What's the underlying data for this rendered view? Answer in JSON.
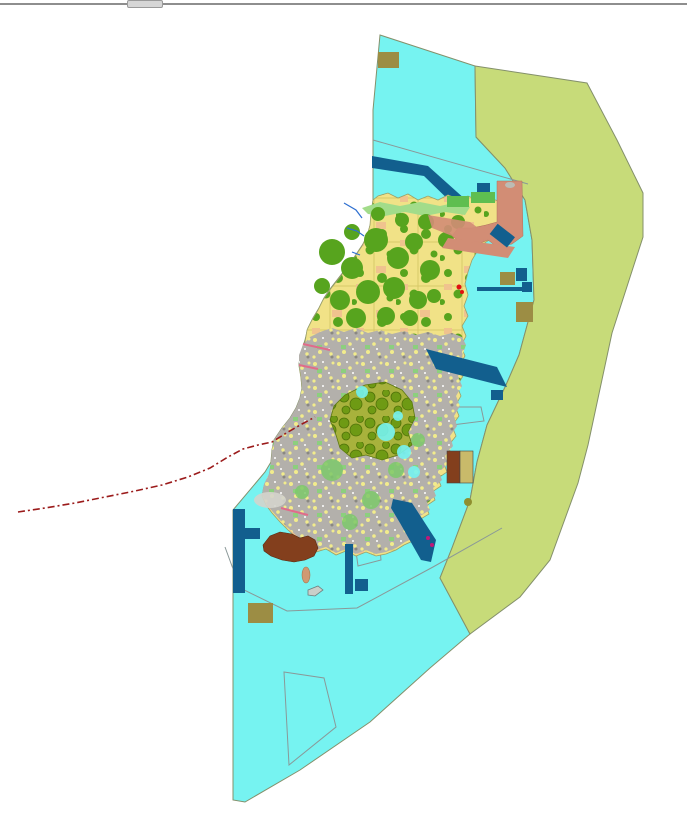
{
  "window": {
    "top_border": "window top border",
    "tab": "window tab stub"
  },
  "map": {
    "title": "coastal land-use zoning map",
    "width": 687,
    "height": 821,
    "background": "#FFFFFF",
    "palette": {
      "chrome-line": "#8E8E8E",
      "chrome-tab": "#D6D6D6",
      "sea": "#76F3F1",
      "olive-zone": "#C7DB79",
      "zone-stroke": "#84906B",
      "farmland": "#F1E287",
      "forest": "#57A41E",
      "orchard": "#F0C38E",
      "urban": "#B3B0AB",
      "parkgreen": "#5FBE50",
      "greens": "#8CCF7E",
      "harbor": "#125F8E",
      "salmon": "#D28D75",
      "brown": "#833F1D",
      "khaki": "#9C8D44",
      "khaki-light": "#C9BA6A",
      "coast-green": "#A2DC8A",
      "stream": "#2E6FD0",
      "boundary": "#9B1B1B",
      "hairline": "#8A9898",
      "forest-dense-base": "#A8B23C",
      "forest-dense-blob": "#6E9A14",
      "tidal": "#D4D4CC",
      "red-marker": "#E01010",
      "magenta-marker": "#C01878",
      "tan": "#D09A72",
      "boat-gray": "#C9CFC9"
    },
    "layers": [
      {
        "name": "sea-planning-area",
        "kind": "polygon",
        "fill": "@sea",
        "stroke": "@zone-stroke",
        "sw": 1,
        "points": "380,35 475,66 476,137 505,168 525,200 532,240 534,300 519,355 506,385 487,425 477,462 470,500 452,548 440,578 470,634 430,668 370,722 300,770 245,802 233,800 233,723 233,510 265,472 271,462 272,450 274,440 282,428 290,418 296,408 300,398 302,388 301,376 299,364 301,352 305,340 308,328 313,318 319,308 324,298 330,289 337,280 344,271 351,262 357,253 363,244 368,234 371,222 372,210 373,200 373,110"
      },
      {
        "name": "olive-buffer-zone",
        "kind": "polygon",
        "fill": "@olive-zone",
        "stroke": "@zone-stroke",
        "sw": 1,
        "points": "475,66 587,83 617,140 643,193 643,237 612,333 588,445 578,483 550,560 520,597 470,634 440,578 452,548 470,500 477,462 487,425 506,385 519,355 534,300 532,240 525,200 505,168 476,137"
      },
      {
        "name": "sea-survey-line-north",
        "kind": "polyline",
        "fill": "none",
        "stroke": "@hairline",
        "sw": 1,
        "points": "373,140 528,184"
      },
      {
        "name": "sea-survey-line-south",
        "kind": "polyline",
        "fill": "none",
        "stroke": "@hairline",
        "sw": 1,
        "points": "225,547 240,588 287,611 357,608 433,567 502,528"
      },
      {
        "name": "survey-quad-south",
        "kind": "polygon",
        "fill": "none",
        "stroke": "@hairline",
        "sw": 1,
        "points": "284,672 324,678 336,727 289,765"
      },
      {
        "name": "survey-quad-harbor",
        "kind": "polygon",
        "fill": "none",
        "stroke": "@hairline",
        "sw": 1,
        "points": "355,544 379,539 381,560 358,566"
      },
      {
        "name": "survey-pentagon-east",
        "kind": "polygon",
        "fill": "none",
        "stroke": "@hairline",
        "sw": 1,
        "points": "432,407 481,407 484,421 452,425 437,423 432,416"
      },
      {
        "name": "breakwater-band-north",
        "kind": "polygon",
        "fill": "@harbor",
        "points": "372,156 428,166 466,200 459,210 424,176 372,168"
      },
      {
        "name": "island-farmland",
        "kind": "polygon",
        "fill": "url(#farmland)",
        "stroke": "#9aa06a",
        "sw": 0.8,
        "points": "373,200 378,196 388,193 398,198 408,194 418,200 428,196 438,200 448,195 458,199 468,196 478,200 488,197 498,201 506,205 512,210 516,218 514,226 505,232 495,236 486,242 478,250 472,260 468,272 465,284 468,295 464,306 468,316 462,326 466,336 461,346 465,356 459,366 463,376 457,386 461,396 455,406 459,416 452,426 456,436 448,446 452,456 444,464 447,472 438,478 441,486 432,492 435,500 426,506 429,514 419,520 422,528 412,533 415,540 404,545 396,550 386,554 376,556 366,552 356,556 346,551 336,555 326,549 316,552 306,545 297,538 288,530 280,522 272,513 266,505 262,496 264,486 269,476 271,464 272,452 274,442 282,430 290,420 296,410 300,400 302,390 301,378 299,366 301,354 305,342 307,330 312,320 318,310 323,300 329,291 336,282 343,273 350,264 356,255 362,246 367,236 370,225 371,212"
      },
      {
        "name": "island-urban-south",
        "kind": "polygon",
        "fill": "url(#urban)",
        "points": "299,355 303,345 310,337 320,332 332,328 344,332 356,328 368,333 380,330 392,334 404,331 416,335 428,332 440,336 452,333 462,337 466,345 462,356 464,366 458,376 462,386 456,396 460,406 454,416 457,426 450,436 453,446 445,456 448,464 439,472 442,480 433,488 436,496 427,502 430,510 420,516 423,524 413,530 416,537 405,542 396,548 386,552 376,554 366,550 356,554 346,549 336,553 326,547 316,550 306,543 297,536 288,528 280,520 272,511 266,503 262,494 264,484 269,474 271,462 272,450 274,440 282,428 290,418 296,408 300,398 302,388 301,376 299,364"
      },
      {
        "name": "coastal-green-strip",
        "kind": "polygon",
        "fill": "@coast-green",
        "points": "362,208 380,202 400,206 420,202 440,206 458,202 470,207 465,215 445,212 425,216 405,212 385,216 368,214"
      },
      {
        "name": "forest-patches-north",
        "kind": "circles",
        "fill": "@forest",
        "items": [
          [
            332,
            252,
            13
          ],
          [
            352,
            268,
            11
          ],
          [
            376,
            240,
            12
          ],
          [
            398,
            258,
            11
          ],
          [
            414,
            242,
            9
          ],
          [
            430,
            270,
            10
          ],
          [
            368,
            292,
            12
          ],
          [
            340,
            300,
            10
          ],
          [
            394,
            288,
            11
          ],
          [
            418,
            300,
            9
          ],
          [
            322,
            286,
            8
          ],
          [
            356,
            318,
            10
          ],
          [
            386,
            316,
            9
          ],
          [
            410,
            318,
            8
          ],
          [
            434,
            296,
            7
          ],
          [
            446,
            240,
            8
          ],
          [
            458,
            222,
            7
          ],
          [
            426,
            222,
            8
          ],
          [
            402,
            220,
            7
          ],
          [
            378,
            214,
            7
          ],
          [
            352,
            232,
            8
          ]
        ]
      },
      {
        "name": "forest-dense-cluster",
        "kind": "polygon",
        "fill": "url(#forestDense)",
        "stroke": "#5d7a10",
        "sw": 0.8,
        "points": "345,395 365,385 385,382 402,390 412,402 415,418 408,432 412,445 398,455 382,460 366,455 352,458 340,448 336,435 330,420 334,406"
      },
      {
        "name": "green-patches-south",
        "kind": "circles",
        "fill": "#7CC96A",
        "opacity": 0.85,
        "items": [
          [
            332,
            470,
            11
          ],
          [
            371,
            500,
            9
          ],
          [
            396,
            470,
            8
          ],
          [
            350,
            522,
            8
          ],
          [
            302,
            492,
            7
          ],
          [
            418,
            440,
            7
          ]
        ]
      },
      {
        "name": "fishpond-inlets",
        "kind": "circles",
        "fill": "@sea",
        "opacity": 0.9,
        "items": [
          [
            386,
            432,
            9
          ],
          [
            404,
            452,
            7
          ],
          [
            362,
            392,
            6
          ],
          [
            414,
            472,
            6
          ],
          [
            398,
            416,
            5
          ]
        ]
      },
      {
        "name": "tidal-flat-west",
        "kind": "ellipse",
        "fill": "@tidal",
        "opacity": 0.9,
        "cx": 270,
        "cy": 500,
        "rx": 16,
        "ry": 8
      },
      {
        "name": "salmon-zone-ne",
        "kind": "polygon",
        "fill": "@salmon",
        "stroke": "#b0705c",
        "sw": 0.5,
        "points": "497,181 522,181 523,236 512,244 497,247 488,240 470,247 460,242 452,236 458,228 472,228 486,225 497,222"
      },
      {
        "name": "salmon-band-ne",
        "kind": "polygon",
        "fill": "@salmon",
        "points": "448,238 515,247 508,258 442,248"
      },
      {
        "name": "salmon-band-island",
        "kind": "polygon",
        "fill": "@salmon",
        "opacity": 0.9,
        "points": "428,215 470,222 492,238 470,243 432,228"
      },
      {
        "name": "gray-blob-salmon",
        "kind": "ellipse",
        "fill": "#BCBCB4",
        "cx": 510,
        "cy": 185,
        "rx": 5,
        "ry": 3
      },
      {
        "name": "park-rect-a",
        "kind": "rect",
        "fill": "@parkgreen",
        "x": 447,
        "y": 196,
        "w": 22,
        "h": 11
      },
      {
        "name": "park-rect-b",
        "kind": "rect",
        "fill": "@parkgreen",
        "x": 471,
        "y": 192,
        "w": 24,
        "h": 11
      },
      {
        "name": "harbor-rect-ne",
        "kind": "rect",
        "fill": "@harbor",
        "x": 477,
        "y": 183,
        "w": 13,
        "h": 9
      },
      {
        "name": "harbor-tilted-ne",
        "kind": "rect",
        "fill": "@harbor",
        "x": 491,
        "y": 229,
        "w": 22,
        "h": 13,
        "transform": "rotate(38 502 236)"
      },
      {
        "name": "harbor-pier-line",
        "kind": "rect",
        "fill": "@harbor",
        "x": 477,
        "y": 287,
        "w": 53,
        "h": 4
      },
      {
        "name": "harbor-block-e",
        "kind": "rect",
        "fill": "@harbor",
        "x": 522,
        "y": 282,
        "w": 10,
        "h": 10
      },
      {
        "name": "harbor-rect-e",
        "kind": "rect",
        "fill": "@harbor",
        "x": 516,
        "y": 268,
        "w": 11,
        "h": 13
      },
      {
        "name": "khaki-rect-e1",
        "kind": "rect",
        "fill": "@khaki",
        "x": 500,
        "y": 272,
        "w": 15,
        "h": 13
      },
      {
        "name": "khaki-rect-e2",
        "kind": "rect",
        "fill": "@khaki",
        "x": 516,
        "y": 302,
        "w": 17,
        "h": 20
      },
      {
        "name": "khaki-rect-top",
        "kind": "rect",
        "fill": "@khaki",
        "x": 378,
        "y": 52,
        "w": 21,
        "h": 16
      },
      {
        "name": "khaki-rect-sw",
        "kind": "rect",
        "fill": "@khaki",
        "x": 248,
        "y": 603,
        "w": 25,
        "h": 20
      },
      {
        "name": "harbor-parallelogram-east",
        "kind": "polygon",
        "fill": "@harbor",
        "points": "426,349 497,367 507,387 436,369"
      },
      {
        "name": "harbor-rect-east-small",
        "kind": "rect",
        "fill": "@harbor",
        "x": 491,
        "y": 390,
        "w": 12,
        "h": 10
      },
      {
        "name": "harbor-band-se",
        "kind": "polygon",
        "fill": "@harbor",
        "points": "393,499 412,503 436,540 431,562 421,560 400,523 391,508"
      },
      {
        "name": "harbor-strip-s",
        "kind": "rect",
        "fill": "@harbor",
        "x": 345,
        "y": 544,
        "w": 8,
        "h": 50
      },
      {
        "name": "harbor-square-s",
        "kind": "rect",
        "fill": "@harbor",
        "x": 355,
        "y": 579,
        "w": 13,
        "h": 12
      },
      {
        "name": "harbor-tbar-west-v",
        "kind": "rect",
        "fill": "@harbor",
        "x": 233,
        "y": 509,
        "w": 12,
        "h": 84
      },
      {
        "name": "harbor-tbar-west-arm",
        "kind": "rect",
        "fill": "@harbor",
        "x": 245,
        "y": 528,
        "w": 15,
        "h": 11
      },
      {
        "name": "brown-landfill-south",
        "kind": "polygon",
        "fill": "@brown",
        "stroke": "#5a2a10",
        "sw": 0.6,
        "points": "263,545 270,536 280,532 292,534 300,538 308,536 315,540 318,548 314,556 305,560 294,562 282,560 271,556 264,551"
      },
      {
        "name": "facility-box-brown",
        "kind": "rect",
        "fill": "@brown",
        "stroke": "#444",
        "sw": 0.6,
        "x": 447,
        "y": 451,
        "w": 13,
        "h": 32
      },
      {
        "name": "facility-box-khaki",
        "kind": "rect",
        "fill": "@khaki-light",
        "stroke": "#444",
        "sw": 0.6,
        "x": 460,
        "y": 451,
        "w": 13,
        "h": 32
      },
      {
        "name": "tan-islet",
        "kind": "ellipse",
        "fill": "@tan",
        "stroke": "#a8764e",
        "sw": 0.6,
        "cx": 306,
        "cy": 575,
        "rx": 4,
        "ry": 8
      },
      {
        "name": "gray-islet-outline",
        "kind": "polygon",
        "fill": "@boat-gray",
        "stroke": "#6f7f7f",
        "sw": 0.8,
        "points": "308,590 318,586 323,590 315,596 308,595"
      },
      {
        "name": "olive-dot",
        "kind": "circles",
        "fill": "#8F8F2F",
        "items": [
          [
            468,
            502,
            4
          ]
        ]
      },
      {
        "name": "red-markers",
        "kind": "circles",
        "fill": "@red-marker",
        "items": [
          [
            459,
            287,
            2.5
          ],
          [
            462,
            292,
            2
          ]
        ]
      },
      {
        "name": "magenta-markers",
        "kind": "circles",
        "fill": "@magenta-marker",
        "items": [
          [
            428,
            538,
            2
          ],
          [
            432,
            545,
            2
          ]
        ]
      },
      {
        "name": "pink-streak-1",
        "kind": "polyline",
        "fill": "none",
        "stroke": "#E06C8A",
        "sw": 2,
        "points": "303,344 330,350"
      },
      {
        "name": "pink-streak-2",
        "kind": "polyline",
        "fill": "none",
        "stroke": "#E06C8A",
        "sw": 2,
        "points": "299,365 318,369"
      },
      {
        "name": "pink-streak-3",
        "kind": "polyline",
        "fill": "none",
        "stroke": "#E06C8A",
        "sw": 2,
        "points": "281,508 308,515"
      },
      {
        "name": "stream-1",
        "kind": "polyline",
        "fill": "none",
        "stroke": "@stream",
        "sw": 1.2,
        "points": "344,203 356,210 362,218"
      },
      {
        "name": "stream-2",
        "kind": "polyline",
        "fill": "none",
        "stroke": "@stream",
        "sw": 1.2,
        "points": "347,228 357,231 364,236"
      },
      {
        "name": "stream-3",
        "kind": "polyline",
        "fill": "none",
        "stroke": "@stream",
        "sw": 1.2,
        "points": "352,252 360,255"
      },
      {
        "name": "boundary-dashline-west",
        "kind": "polyline",
        "fill": "none",
        "stroke": "@boundary",
        "sw": 1.6,
        "dash": "7 3 2 3",
        "points": "18,512 45,508 75,503 105,497 135,491 162,485 188,477 210,468 228,457 243,449 258,445 272,442 288,432 302,424 315,417"
      }
    ]
  }
}
